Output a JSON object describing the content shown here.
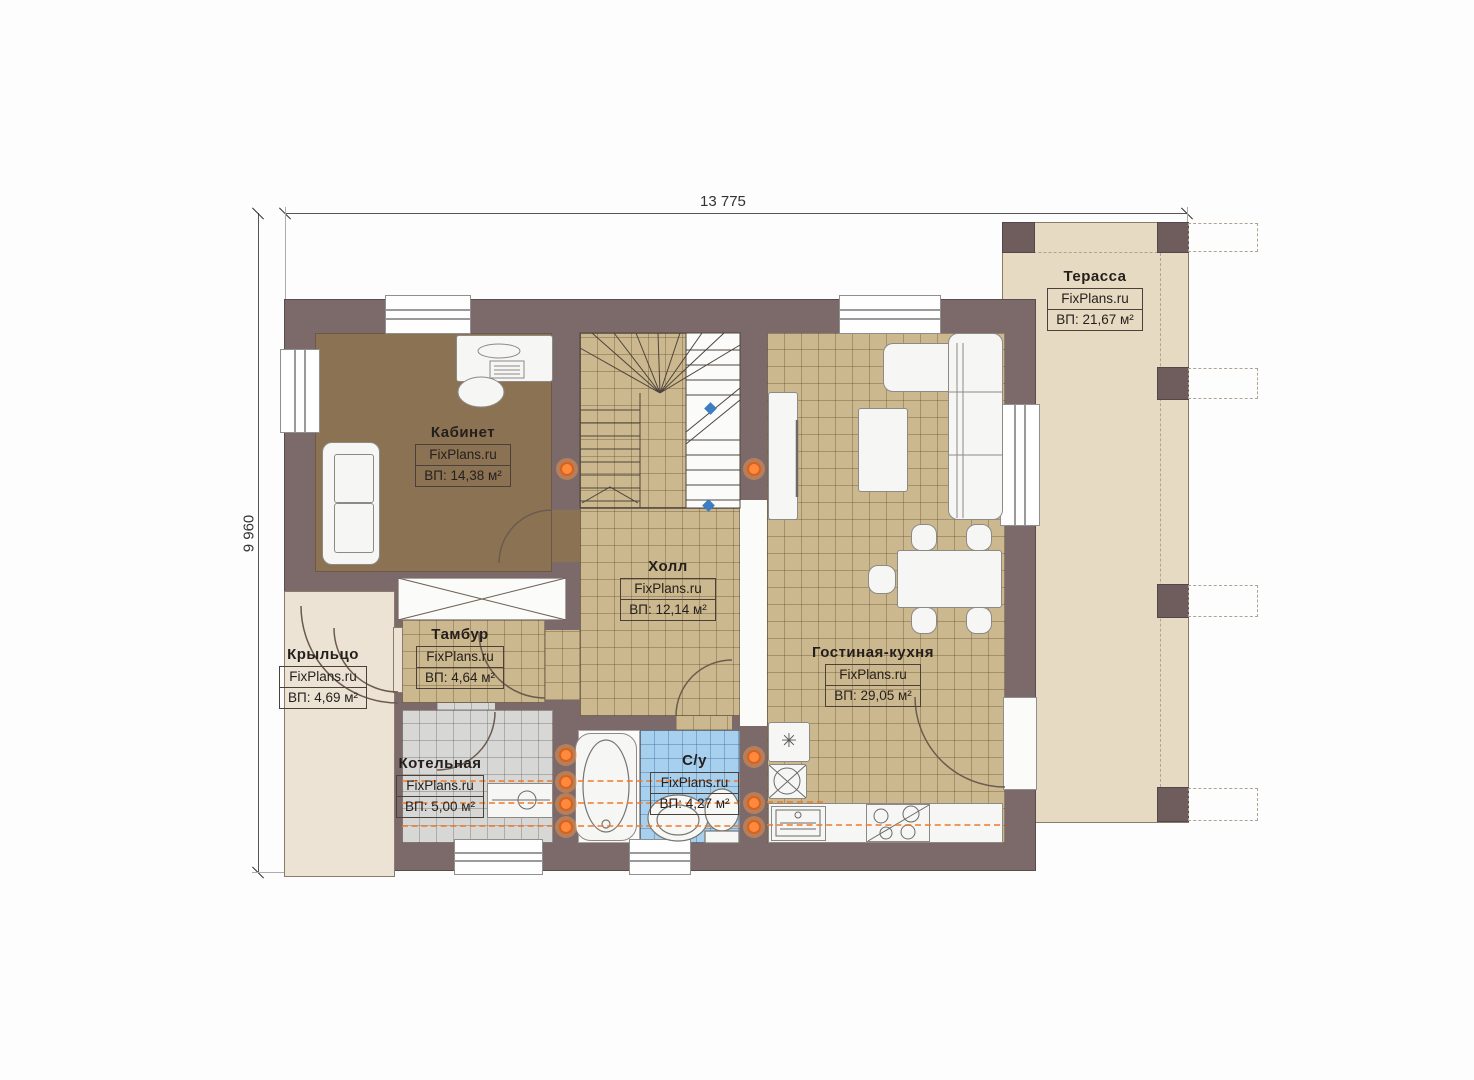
{
  "plan": {
    "dimensions": {
      "width_label": "13 775",
      "height_label": "9 960"
    },
    "brand": "FixPlans.ru",
    "rooms": [
      {
        "id": "office",
        "name": "Кабинет",
        "area": "ВП: 14,38 м²"
      },
      {
        "id": "terrace",
        "name": "Терасса",
        "area": "ВП: 21,67 м²"
      },
      {
        "id": "hall",
        "name": "Холл",
        "area": "ВП: 12,14 м²"
      },
      {
        "id": "vestibule",
        "name": "Тамбур",
        "area": "ВП: 4,64 м²"
      },
      {
        "id": "porch",
        "name": "Крыльцо",
        "area": "ВП: 4,69 м²"
      },
      {
        "id": "boiler",
        "name": "Котельная",
        "area": "ВП: 5,00 м²"
      },
      {
        "id": "bathroom",
        "name": "С/у",
        "area": "ВП: 4,27 м²"
      },
      {
        "id": "living",
        "name": "Гостиная-кухня",
        "area": "ВП: 29,05 м²"
      }
    ],
    "symbols": {
      "fridge_snowflake": "✳"
    }
  }
}
